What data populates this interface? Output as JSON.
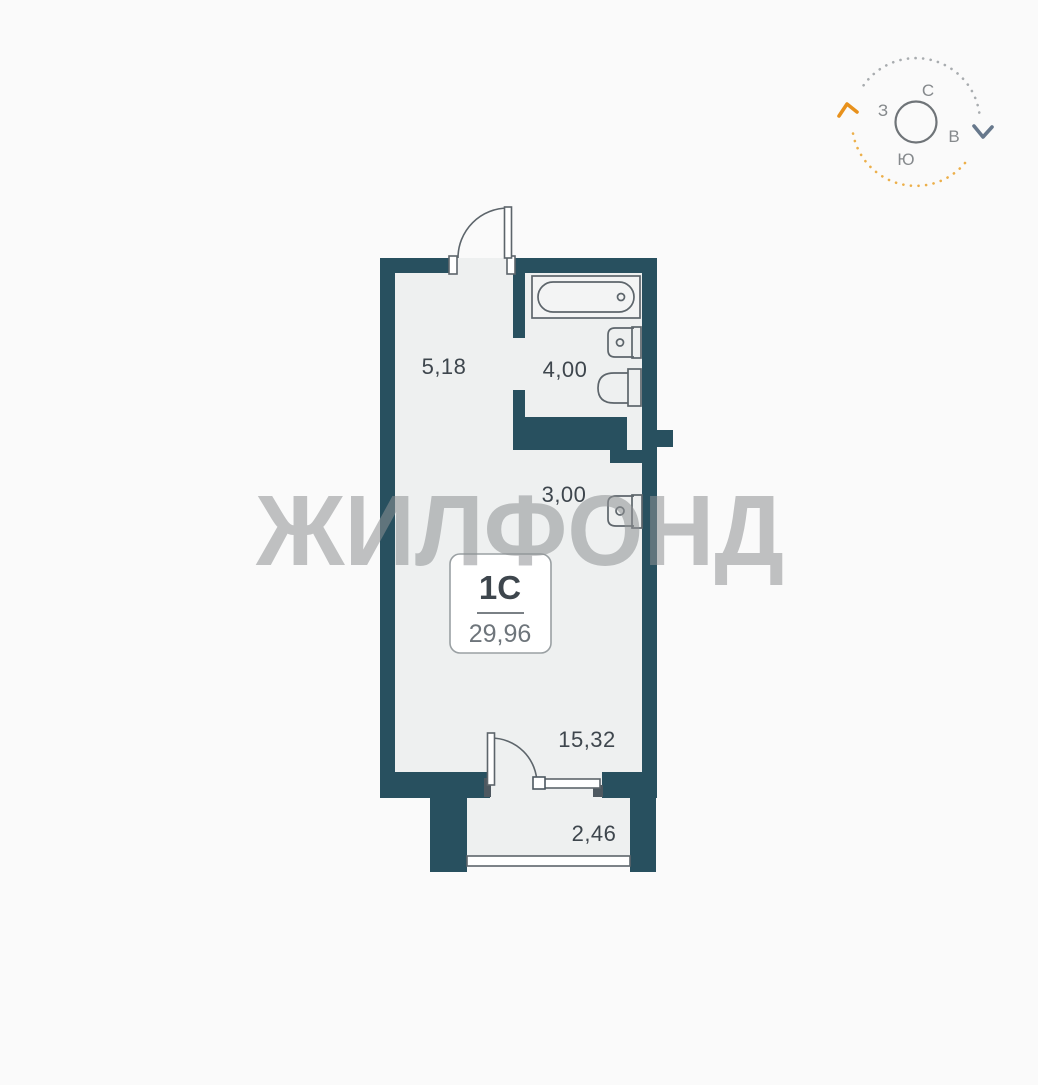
{
  "compass": {
    "north": "С",
    "east": "В",
    "south": "Ю",
    "west": "З"
  },
  "watermark": {
    "text": "ЖИЛФОНД",
    "color": "#8f9294"
  },
  "unit": {
    "type": "1С",
    "total_area": "29,96"
  },
  "rooms": [
    {
      "name": "hallway",
      "area": "5,18"
    },
    {
      "name": "bathroom",
      "area": "4,00"
    },
    {
      "name": "kitchen-niche",
      "area": "3,00"
    },
    {
      "name": "living-room",
      "area": "15,32"
    },
    {
      "name": "balcony",
      "area": "2,46"
    }
  ],
  "colors": {
    "wall": "#28505f",
    "room_fill": "#eef0f0",
    "fixture_outline": "#5d656b",
    "label_text": "#3e464d",
    "secondary_text": "#6e757b",
    "page_background": "#fafafa",
    "compass_gray": "#a8acaf",
    "compass_slate": "#67788c",
    "compass_orange_light": "#ecaf4a",
    "compass_orange": "#e8911c",
    "compass_letters": "#85898c",
    "compass_circle": "#6f7478"
  }
}
